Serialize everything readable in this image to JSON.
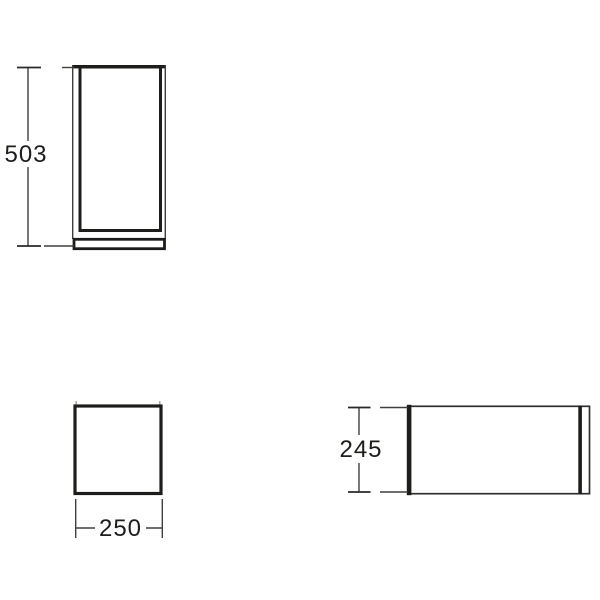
{
  "dimensions": {
    "front_height": "503",
    "top_width": "250",
    "side_depth": "245"
  },
  "colors": {
    "background": "#ffffff",
    "line_primary": "#1d1d1b",
    "line_secondary": "#3f3f3f"
  }
}
